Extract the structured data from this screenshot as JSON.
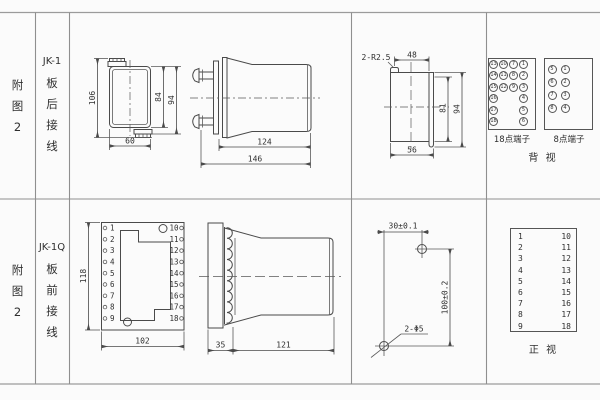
{
  "colors": {
    "background": "#fbfbfb",
    "grid_line": "#9b9b9b",
    "drawing_line": "#4a4a4a",
    "text": "#2e2e2e"
  },
  "labels": {
    "top": {
      "figure": [
        "附",
        "图",
        "2"
      ],
      "model": "JK-1",
      "wiring": [
        "板",
        "后",
        "接",
        "线"
      ]
    },
    "bottom": {
      "figure": [
        "附",
        "图",
        "2"
      ],
      "model": "JK-1Q",
      "wiring": [
        "板",
        "前",
        "接",
        "线"
      ]
    }
  },
  "rear": {
    "view1": {
      "h_total": "106",
      "h_case": "84",
      "h_mid": "94",
      "w": "60"
    },
    "view2": {
      "d_body": "124",
      "d_total": "146"
    },
    "view3": {
      "note": "2-R2.5",
      "w_top": "48",
      "h_in": "81",
      "h_out": "94",
      "w_bottom": "56"
    },
    "t18": {
      "label": "18点端子",
      "cells": [
        "13",
        "10",
        "7",
        "1",
        "14",
        "11",
        "8",
        "2",
        "15",
        "12",
        "9",
        "3",
        "16",
        "4",
        "17",
        "5",
        "18",
        "6"
      ]
    },
    "t8": {
      "label": "8点端子",
      "cells": [
        "5",
        "1",
        "6",
        "2",
        "7",
        "3",
        "8",
        "4"
      ]
    },
    "view_label": "背 视"
  },
  "front": {
    "view1": {
      "h": "118",
      "w": "102"
    },
    "terminals_left": [
      "1",
      "2",
      "3",
      "4",
      "5",
      "6",
      "7",
      "8",
      "9"
    ],
    "terminals_right": [
      "10",
      "11",
      "12",
      "13",
      "14",
      "15",
      "16",
      "17",
      "18"
    ],
    "view2": {
      "d_plate": "35",
      "d_body": "121"
    },
    "drill": {
      "w": "30±0.1",
      "h": "100±0.2",
      "note": "2-Φ5"
    },
    "table_label": "正 视"
  }
}
